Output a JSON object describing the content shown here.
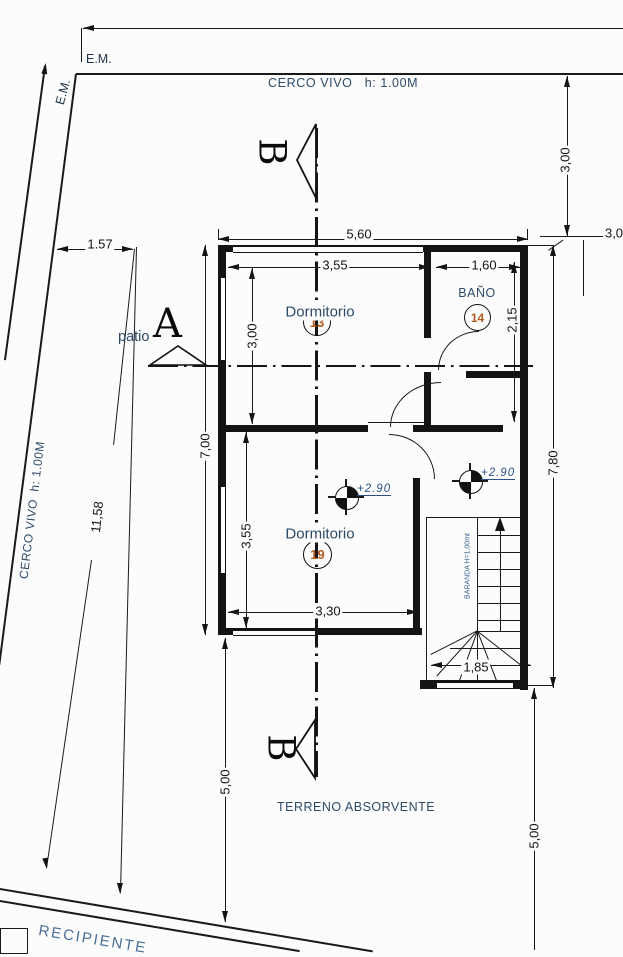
{
  "labels": {
    "em_top": "E.M.",
    "em_side": "E.M.",
    "cerco_top": "CERCO VIVO   h: 1.00M",
    "cerco_left": "CERCO VIVO  h: 1.00M",
    "patio": "patio",
    "terreno": "TERRENO ABSORVENTE",
    "recipiente": "RECIPIENTE",
    "baranda": "BARANDA H=1.00mt"
  },
  "sections": {
    "a": "A",
    "b_top": "B",
    "b_bottom": "B"
  },
  "rooms": [
    {
      "name": "Dormitorio",
      "number": "13"
    },
    {
      "name": "BAÑO",
      "number": "14"
    },
    {
      "name": "Dormitorio",
      "number": "19"
    }
  ],
  "levels": {
    "hall": "+2.90",
    "stair": "+2.90"
  },
  "dims": {
    "d157": "1.57",
    "d1158": "11,58",
    "d560": "5,60",
    "d355a": "3,55",
    "d160": "1,60",
    "d300r": "3,00",
    "d30cut": "3,0",
    "d215": "2,15",
    "d300a": "3,00",
    "d700": "7,00",
    "d355b": "3,55",
    "d330": "3,30",
    "d780": "7,80",
    "d185": "1,85",
    "d500l": "5,00",
    "d500r": "5,00"
  }
}
